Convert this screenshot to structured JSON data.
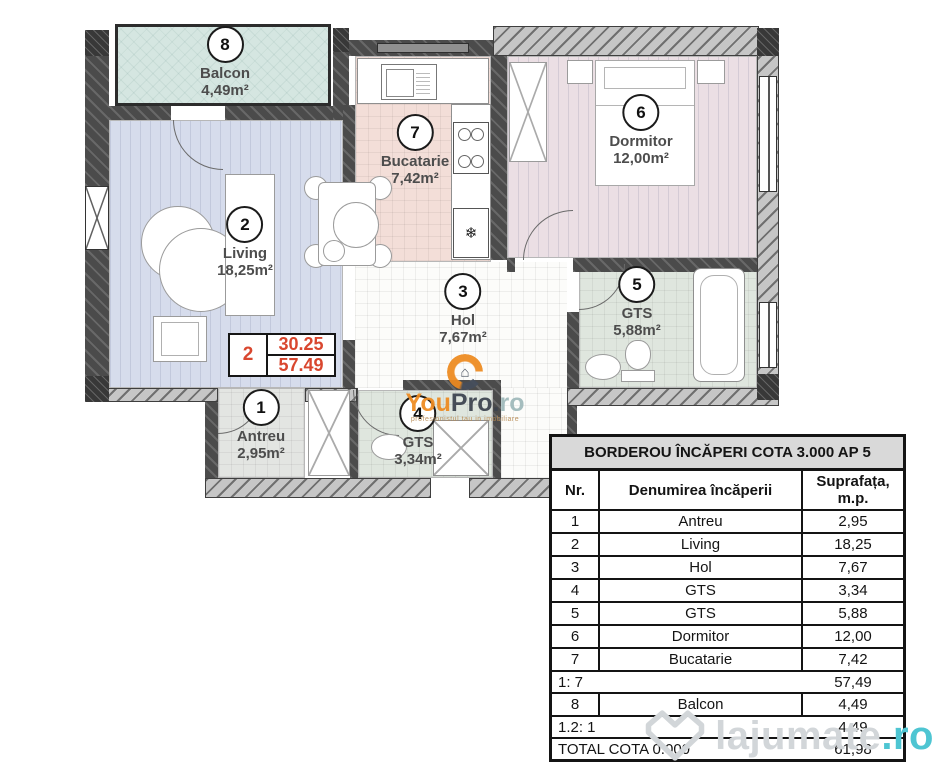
{
  "plan": {
    "rooms": [
      {
        "id": "balcon",
        "number": "8",
        "name": "Balcon",
        "area": "4,49m²"
      },
      {
        "id": "living",
        "number": "2",
        "name": "Living",
        "area": "18,25m²"
      },
      {
        "id": "bucatarie",
        "number": "7",
        "name": "Bucatarie",
        "area": "7,42m²"
      },
      {
        "id": "dormitor",
        "number": "6",
        "name": "Dormitor",
        "area": "12,00m²"
      },
      {
        "id": "hol",
        "number": "3",
        "name": "Hol",
        "area": "7,67m²"
      },
      {
        "id": "gts-mare",
        "number": "5",
        "name": "GTS",
        "area": "5,88m²"
      },
      {
        "id": "antreu",
        "number": "1",
        "name": "Antreu",
        "area": "2,95m²"
      },
      {
        "id": "gts-mic",
        "number": "4",
        "name": "GTS",
        "area": "3,34m²"
      }
    ],
    "annotation": {
      "room_number": "2",
      "value_top": "30.25",
      "value_bottom": "57.49"
    },
    "fridge_symbol": "❄"
  },
  "watermarks": {
    "youpro": {
      "brand_orange": "You",
      "brand_dark": "Pro.",
      "brand_suffix": "ro",
      "tagline": "profesionistul tau in imobiliare",
      "house_glyph": "⌂"
    },
    "lajumate": {
      "brand": "lajumate",
      "tld": ".ro"
    }
  },
  "table": {
    "title": "BORDEROU ÎNCĂPERI COTA 3.000 AP 5",
    "headers": {
      "nr": "Nr.",
      "name": "Denumirea încăperii",
      "area": "Suprafața, m.p."
    },
    "rows": [
      {
        "nr": "1",
        "name": "Antreu",
        "area": "2,95"
      },
      {
        "nr": "2",
        "name": "Living",
        "area": "18,25"
      },
      {
        "nr": "3",
        "name": "Hol",
        "area": "7,67"
      },
      {
        "nr": "4",
        "name": "GTS",
        "area": "3,34"
      },
      {
        "nr": "5",
        "name": "GTS",
        "area": "5,88"
      },
      {
        "nr": "6",
        "name": "Dormitor",
        "area": "12,00"
      },
      {
        "nr": "7",
        "name": "Bucatarie",
        "area": "7,42"
      }
    ],
    "subtotal_interior": {
      "label": "1: 7",
      "value": "57,49"
    },
    "balcony_row": {
      "nr": "8",
      "name": "Balcon",
      "area": "4,49"
    },
    "subtotal_balcony": {
      "label": "1.2: 1",
      "value": "4,49"
    },
    "total_row": {
      "label": "TOTAL COTA 0.000",
      "value": "61,98"
    }
  },
  "colors": {
    "accent_red": "#d9472f",
    "lajumate_teal": "#4ec5d2",
    "youpro_orange": "#ee8a1f"
  }
}
